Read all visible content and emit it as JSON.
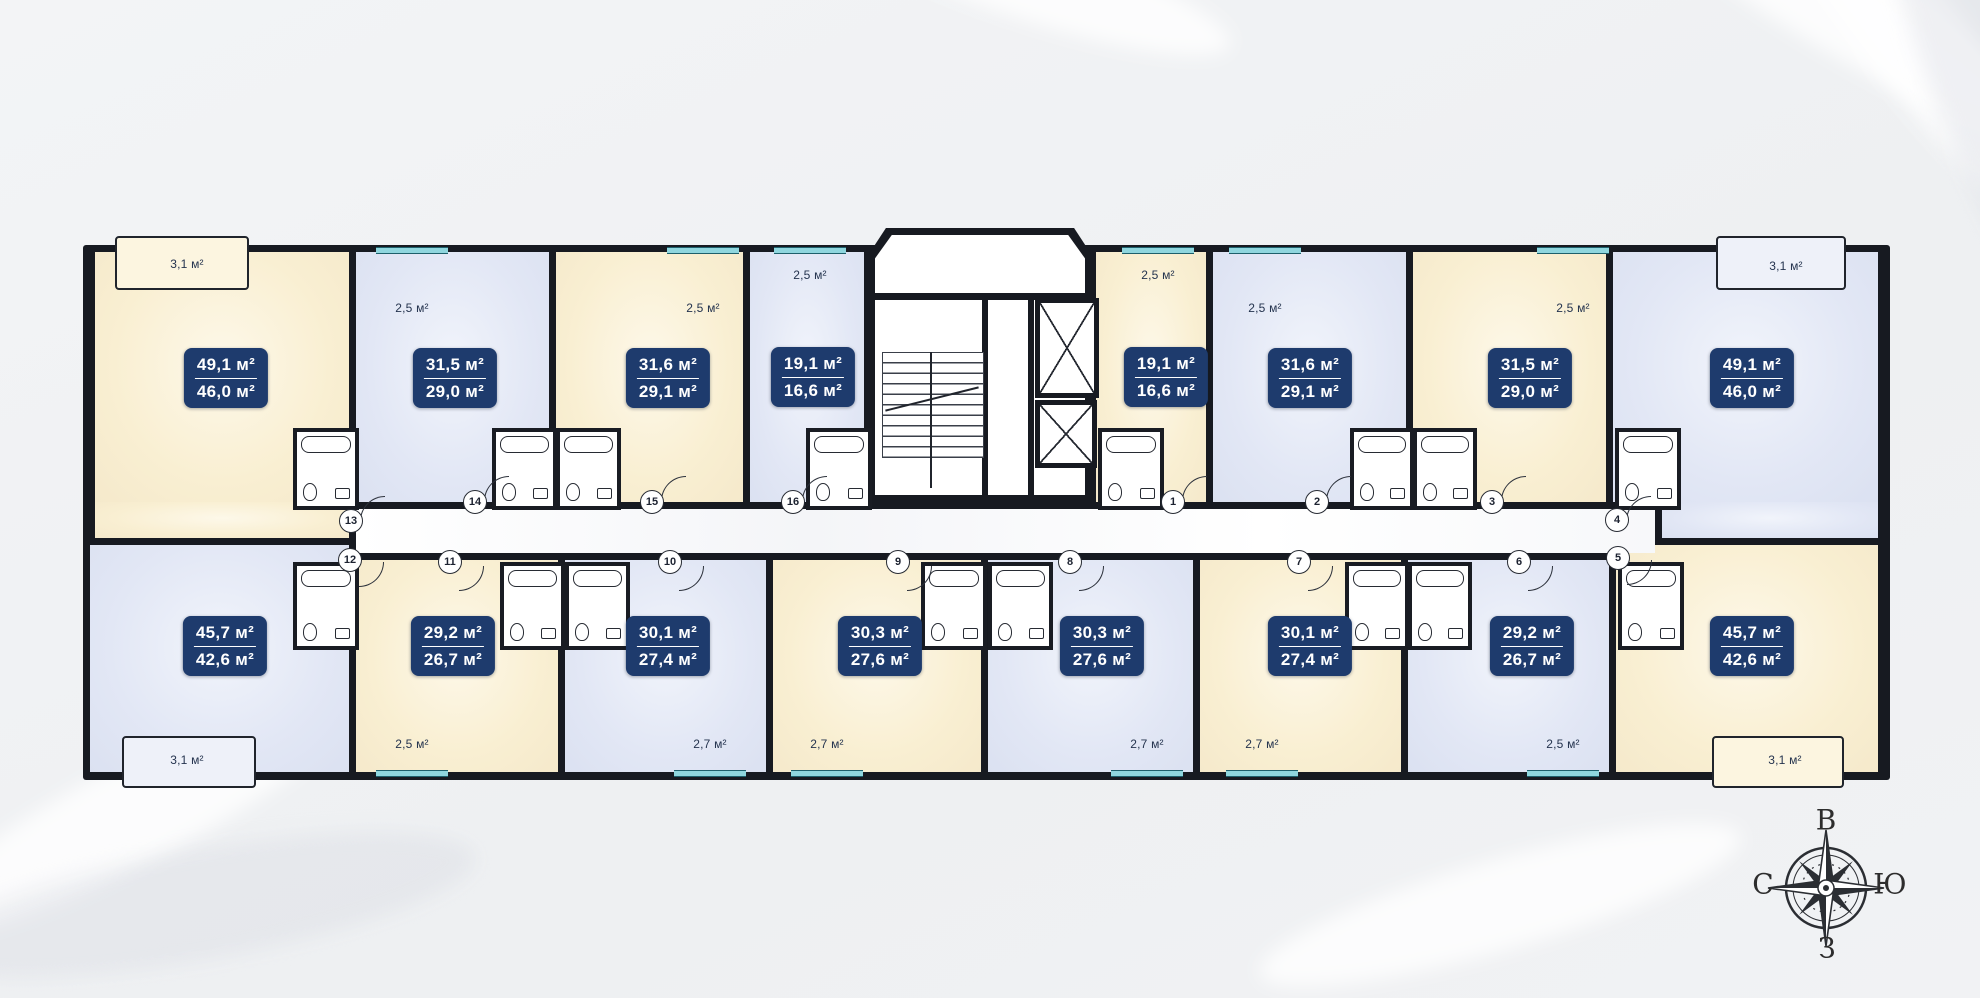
{
  "plan": {
    "type": "residential-floor-plan",
    "unit_count": 16,
    "colors": {
      "background": "#eef0f2",
      "walls": "#171a21",
      "apartment_cream": "#f9efd2",
      "apartment_blue": "#dfe4f3",
      "badge": "#1e3b6d",
      "badge_text": "#ffffff",
      "window_accent": "#8fd6de",
      "corridor": "#ffffff"
    },
    "icons": {
      "elevator": "crossed-box-icon",
      "staircase": "stair-treads-icon",
      "compass": "eight-point-rose-icon",
      "bathroom": "tub-toilet-sink-icon"
    }
  },
  "apartments": [
    {
      "number": "13",
      "area_total": "49,1 м²",
      "area_living": "46,0 м²",
      "balcony": "3,1 м²",
      "fill": "cream",
      "row": "top"
    },
    {
      "number": "14",
      "area_total": "31,5 м²",
      "area_living": "29,0 м²",
      "balcony": "2,5 м²",
      "fill": "blue",
      "row": "top"
    },
    {
      "number": "15",
      "area_total": "31,6 м²",
      "area_living": "29,1 м²",
      "balcony": "2,5 м²",
      "fill": "cream",
      "row": "top"
    },
    {
      "number": "16",
      "area_total": "19,1 м²",
      "area_living": "16,6 м²",
      "balcony": "2,5 м²",
      "fill": "blue",
      "row": "top"
    },
    {
      "number": "1",
      "area_total": "19,1 м²",
      "area_living": "16,6 м²",
      "balcony": "2,5 м²",
      "fill": "cream",
      "row": "top"
    },
    {
      "number": "2",
      "area_total": "31,6 м²",
      "area_living": "29,1 м²",
      "balcony": "2,5 м²",
      "fill": "blue",
      "row": "top"
    },
    {
      "number": "3",
      "area_total": "31,5 м²",
      "area_living": "29,0 м²",
      "balcony": "2,5 м²",
      "fill": "cream",
      "row": "top"
    },
    {
      "number": "4",
      "area_total": "49,1 м²",
      "area_living": "46,0 м²",
      "balcony": "3,1 м²",
      "fill": "blue",
      "row": "top"
    },
    {
      "number": "12",
      "area_total": "45,7 м²",
      "area_living": "42,6 м²",
      "balcony": "3,1 м²",
      "fill": "blue",
      "row": "bottom"
    },
    {
      "number": "11",
      "area_total": "29,2 м²",
      "area_living": "26,7 м²",
      "balcony": "2,5 м²",
      "fill": "cream",
      "row": "bottom"
    },
    {
      "number": "10",
      "area_total": "30,1 м²",
      "area_living": "27,4 м²",
      "balcony": "2,7 м²",
      "fill": "blue",
      "row": "bottom"
    },
    {
      "number": "9",
      "area_total": "30,3 м²",
      "area_living": "27,6 м²",
      "balcony": "2,7 м²",
      "fill": "cream",
      "row": "bottom"
    },
    {
      "number": "8",
      "area_total": "30,3 м²",
      "area_living": "27,6 м²",
      "balcony": "2,7 м²",
      "fill": "blue",
      "row": "bottom"
    },
    {
      "number": "7",
      "area_total": "30,1 м²",
      "area_living": "27,4 м²",
      "balcony": "2,7 м²",
      "fill": "cream",
      "row": "bottom"
    },
    {
      "number": "6",
      "area_total": "29,2 м²",
      "area_living": "26,7 м²",
      "balcony": "2,5 м²",
      "fill": "blue",
      "row": "bottom"
    },
    {
      "number": "5",
      "area_total": "45,7 м²",
      "area_living": "42,6 м²",
      "balcony": "3,1 м²",
      "fill": "cream",
      "row": "bottom"
    }
  ],
  "compass": {
    "top": "В",
    "right": "Ю",
    "bottom": "З",
    "left": "С"
  }
}
